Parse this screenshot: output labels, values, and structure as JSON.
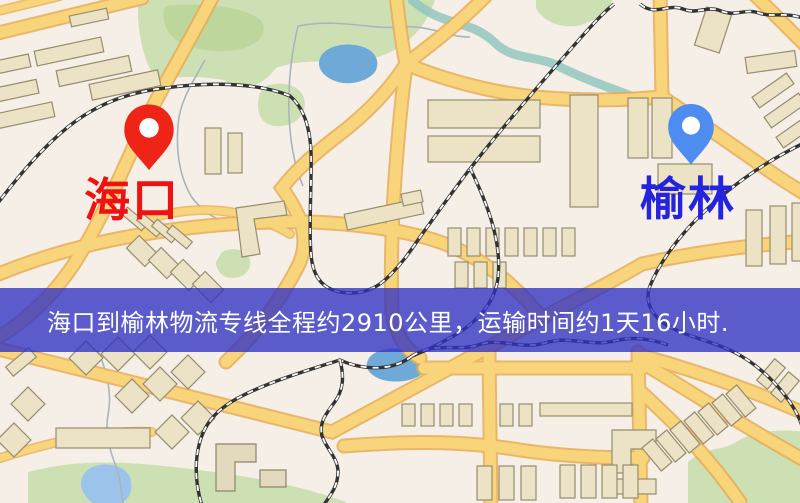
{
  "image_type": "logistics-route-map",
  "banner": {
    "text": "海口到榆林物流专线全程约2910公里，运输时间约1天16小时.",
    "bg_color": "#2f31c3",
    "bg_opacity": 0.78,
    "text_color": "#ffffff"
  },
  "markers": {
    "origin": {
      "label": "海口",
      "label_color": "#ee1212",
      "pin_color": "#ee2416",
      "pin_style": "map-pin-with-hole"
    },
    "destination": {
      "label": "榆林",
      "label_color": "#2424de",
      "pin_color": "#4f8cf0",
      "pin_style": "map-pin-with-hole"
    }
  },
  "map_colors": {
    "base": "#f5efe7",
    "road_fill": "#f8d47a",
    "road_casing": "#e9ad55",
    "building_fill": "#ece3c6",
    "building_stroke": "#968d6c",
    "park": "#cde0b4",
    "park_dark": "#bcd69c",
    "water": "#6ea9d8",
    "water_light": "#9cc4ea",
    "river_teal": "#8cc4bd",
    "stream": "#a9b4be",
    "railway": "#333333"
  }
}
